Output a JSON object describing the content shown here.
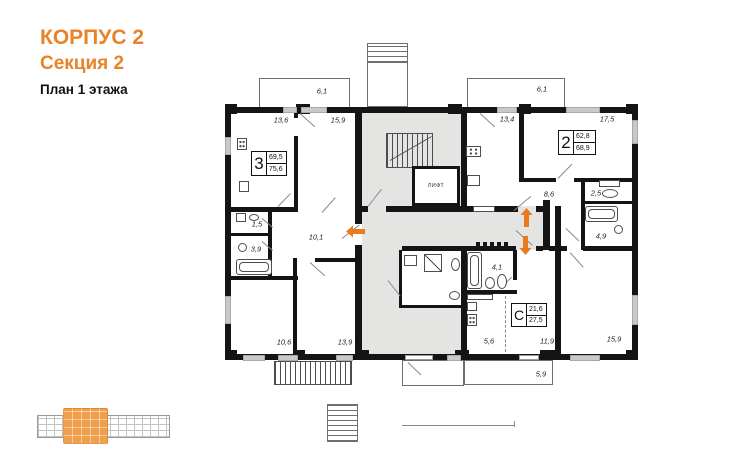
{
  "header": {
    "building": "КОРПУС 2",
    "section": "Секция 2",
    "floor": "План 1 этажа"
  },
  "apartments": {
    "apt3": {
      "type": "3",
      "living": "69,5",
      "total": "75,6"
    },
    "apt2": {
      "type": "2",
      "living": "62,8",
      "total": "68,9"
    },
    "studio": {
      "type": "С",
      "living": "21,6",
      "total": "27,5"
    }
  },
  "rooms": {
    "balcony_left": "6,1",
    "balcony_right": "6,1",
    "r136": "13,6",
    "r159a": "15,9",
    "r134": "13,4",
    "r175": "17,5",
    "r86": "8,6",
    "r25": "2,5",
    "r49": "4,9",
    "r15": "1,5",
    "r101": "10,1",
    "r39": "3,9",
    "r41": "4,1",
    "r106": "10,6",
    "r139": "13,9",
    "r56": "5,6",
    "r119": "11,9",
    "r159b": "15,9",
    "balcony_bottom": "5,9"
  },
  "labels": {
    "elevator": "ЛИФТ"
  },
  "colors": {
    "accent": "#E8832A",
    "arrow": "#E87B1E",
    "common_area": "#E4E4E3",
    "wall": "#141414",
    "window": "#C9C9C9",
    "minimap_highlight": "#F0A04C"
  }
}
